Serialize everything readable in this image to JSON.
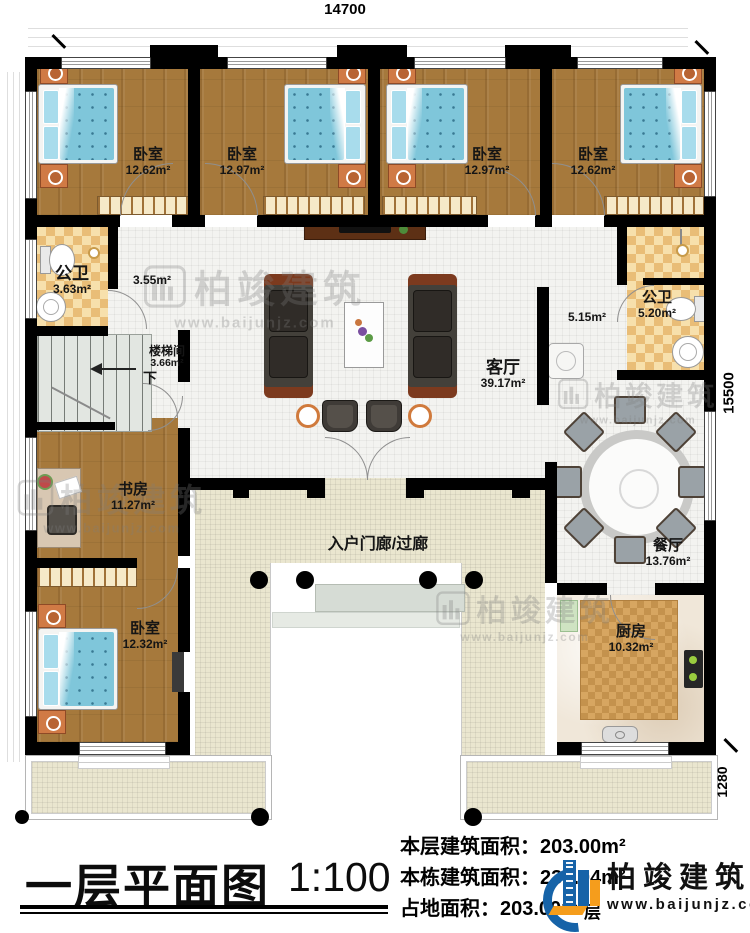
{
  "dimensions": {
    "top": "14700",
    "right": "15500",
    "bottom_right": "1280"
  },
  "rooms": [
    {
      "name": "卧室",
      "area": "12.62m²"
    },
    {
      "name": "卧室",
      "area": "12.97m²"
    },
    {
      "name": "卧室",
      "area": "12.97m²"
    },
    {
      "name": "卧室",
      "area": "12.62m²"
    },
    {
      "name": "公卫",
      "area": "3.63m²"
    },
    {
      "name": "楼梯间",
      "area": "3.66m²",
      "extra": "下"
    },
    {
      "name": "公卫",
      "area": "5.20m²"
    },
    {
      "name": "客厅",
      "area": "39.17m²"
    },
    {
      "name": "书房",
      "area": "11.27m²"
    },
    {
      "name": "卧室",
      "area": "12.32m²"
    },
    {
      "name": "餐厅",
      "area": "13.76m²"
    },
    {
      "name": "厨房",
      "area": "10.32m²"
    }
  ],
  "corridors": {
    "left": "3.55m²",
    "right": "5.15m²"
  },
  "porch": {
    "label": "入户门廊/过廊"
  },
  "brand": {
    "name": "柏竣建筑",
    "site": "www.baijunjz.com"
  },
  "title_block": {
    "title": "一层平面图",
    "scale": "1:100",
    "obscured_fragment": "层",
    "stats": [
      {
        "label": "本层建筑面积：",
        "value": "203.00m²"
      },
      {
        "label": "本栋建筑面积：",
        "value": "239.04m²"
      },
      {
        "label": "占地面积：",
        "value": "203.00m²"
      }
    ]
  },
  "colors": {
    "wall": "#000000",
    "wood_floor": "#a6793c",
    "bath_tile": "#e9bd77",
    "bed_blue": "#7fc6da",
    "logo_blue": "#1663a8",
    "logo_orange": "#f59d1c"
  }
}
